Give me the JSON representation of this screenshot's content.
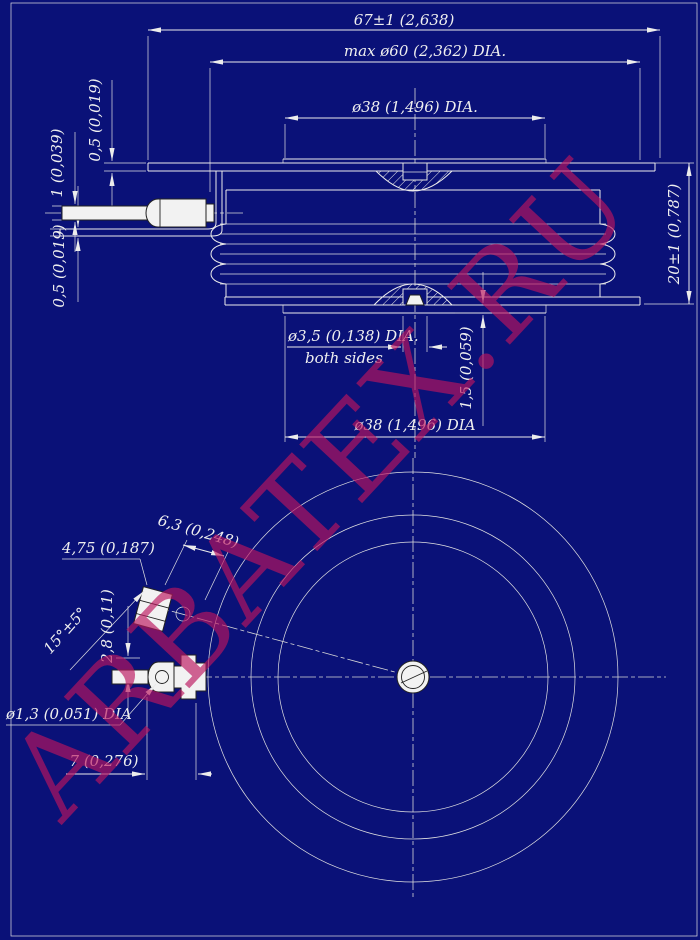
{
  "watermark": {
    "text": "ARBATEX.RU"
  },
  "colors": {
    "background": "#0A1178",
    "lines": "#ECECEC",
    "white_fill": "#F2F2F2",
    "watermark": "rgba(186,22,94,0.66)"
  },
  "section_view": {
    "dim_overall_width": "67±1 (2,638)",
    "dim_max_body_dia": "max ø60 (2,362) DIA.",
    "dim_pole_face_dia_top": "ø38 (1,496) DIA.",
    "dim_flange_thickness_top": "0,5 (0,019)",
    "dim_lead_thickness": "1 (0,039)",
    "dim_flange_thickness_bottom": "0,5 (0,019)",
    "dim_height": "20±1 (0,787)",
    "dim_center_hole_dia": "ø3,5 (0,138) DIA.",
    "dim_center_hole_note": "both sides",
    "dim_pole_face_step": "1,5 (0,059)",
    "dim_pole_face_dia_bottom": "ø38 (1,496) DIA"
  },
  "plan_view": {
    "dim_lug_offset": "4,75 (0,187)",
    "dim_lug_width": "6,3 (0,248)",
    "dim_lug_angle": "15°±5°",
    "dim_lug_gap": "2,8 (0,11)",
    "dim_lead_hole_dia": "ø1,3 (0,051) DIA",
    "dim_connector_length": "7 (0,276)"
  }
}
